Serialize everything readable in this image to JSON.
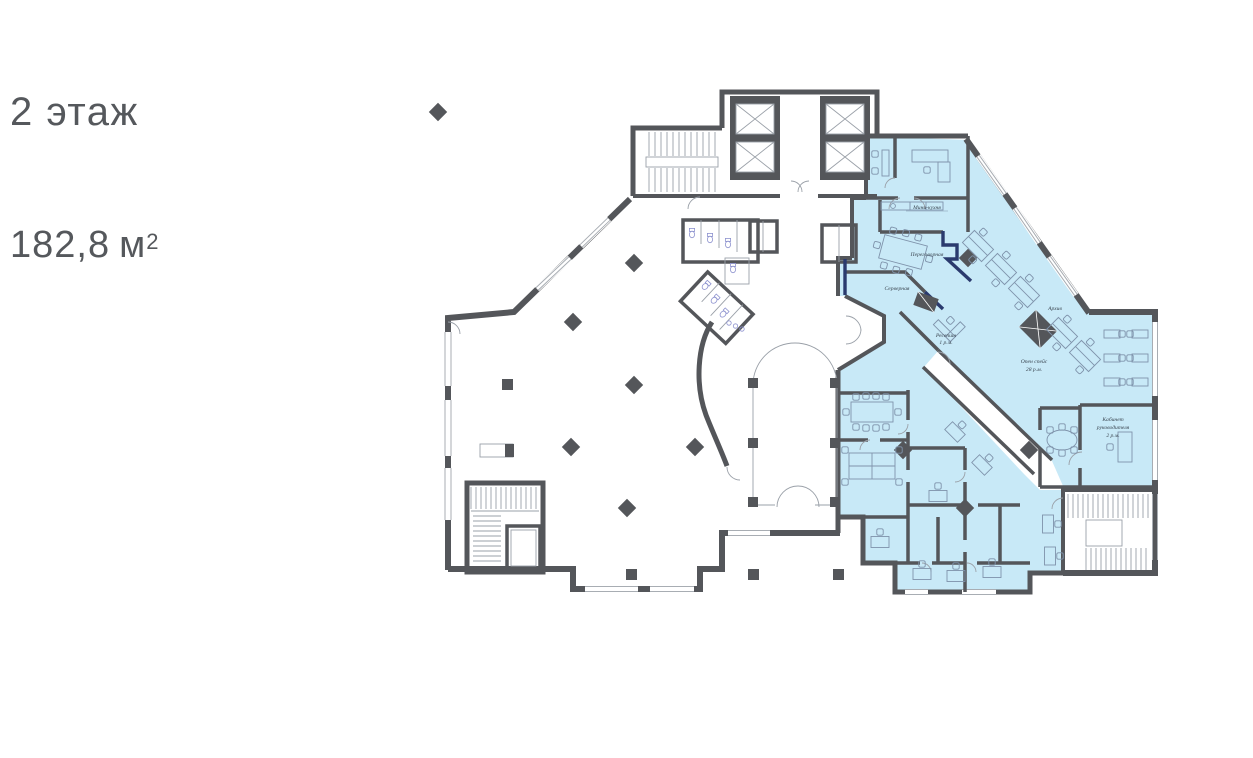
{
  "header": {
    "floor_title": "2 этаж",
    "area_value": "182,8",
    "area_unit": "м",
    "area_superscript": "2"
  },
  "colors": {
    "wall": "#54565a",
    "leased_area_fill": "#c8e9f7",
    "demising_accent_navy": "#2a3a6e",
    "furniture_line": "#7f93ab",
    "window_line": "#a8adb3",
    "title_text": "#55585c",
    "room_label_text": "#3a4550"
  },
  "rooms": {
    "mini_kitchen": {
      "label": "Мини-кухня"
    },
    "meeting": {
      "label": "Переговорная"
    },
    "server": {
      "label": "Серверная"
    },
    "reception": {
      "label": "Ресепшн",
      "capacity": "1 р.м."
    },
    "archive": {
      "label": "Архив"
    },
    "open_space": {
      "label": "Опен спейс",
      "capacity": "28 р.м."
    },
    "director_office": {
      "label": "Кабинет",
      "label2": "руководителя",
      "capacity": "2 р.м."
    }
  }
}
